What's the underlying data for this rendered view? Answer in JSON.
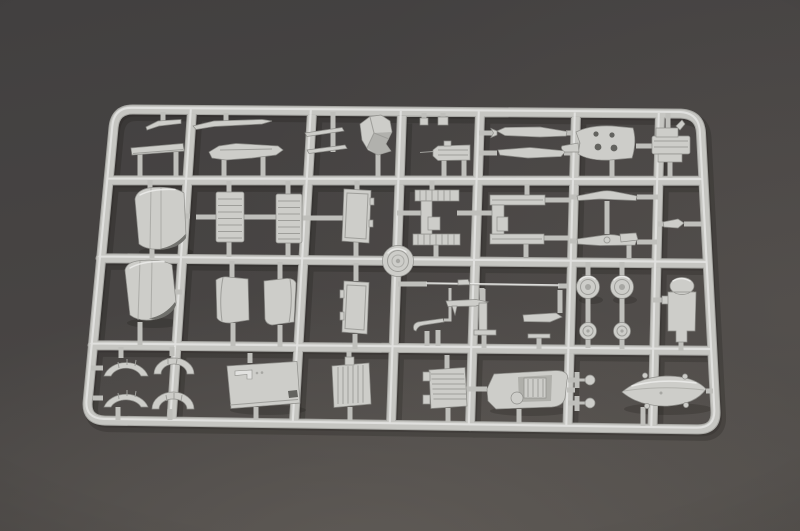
{
  "scene": {
    "description": "Photograph of a light gray plastic model-kit sprue (injection-molded parts tree) lying on a dark gray studio surface, lit from the upper left",
    "object": "model kit sprue with small aircraft parts",
    "visible_text": "",
    "rows_of_parts": 4,
    "approx_part_count": 45
  },
  "colors": {
    "bg-outer": "#3e3c3a",
    "bg-mid": "#4a4745",
    "bg-light": "#5e5a56",
    "plastic-base": "#c6c6c2",
    "plastic-face": "#cdcdc9",
    "plastic-hl": "#ebebe9",
    "plastic-edge": "#8f8f8b",
    "plastic-shade": "#a7a7a3",
    "hole-dark": "#63635f",
    "shadow": "rgba(22,19,17,0.20)"
  },
  "parts": [
    "small-blade",
    "long-blade",
    "airfoil-bench",
    "fuselage-spine",
    "thin-strip-pair",
    "crumpled-cowl-flap",
    "tiny-block-pair",
    "gun-breech",
    "long-half-upper",
    "long-half-lower",
    "cowl-bracket-with-holes",
    "layered-clamp",
    "engine-cowling",
    "ribbed-panel-left",
    "ribbed-panel-right",
    "door-panel",
    "tread-frame",
    "open-frame",
    "tailplane-upper",
    "tailplane-lower",
    "small-clip",
    "sprue-hub",
    "cowling-half",
    "curved-panel-left",
    "curved-panel-right",
    "door-panel-2",
    "long-rod",
    "small-wing-tab",
    "antenna-bracket",
    "l-bracket",
    "angled-flat",
    "wheel-left",
    "wheel-right",
    "hub-disc-left",
    "hub-disc-right",
    "dome-top-part",
    "small-clip-2",
    "arc-segment-1",
    "arc-segment-2",
    "arc-segment-3",
    "arc-segment-4",
    "equipment-box",
    "finned-engine-block",
    "louvered-block",
    "hull-tub-with-engine",
    "axle-fork-upper",
    "axle-fork-lower",
    "float-pontoon"
  ]
}
